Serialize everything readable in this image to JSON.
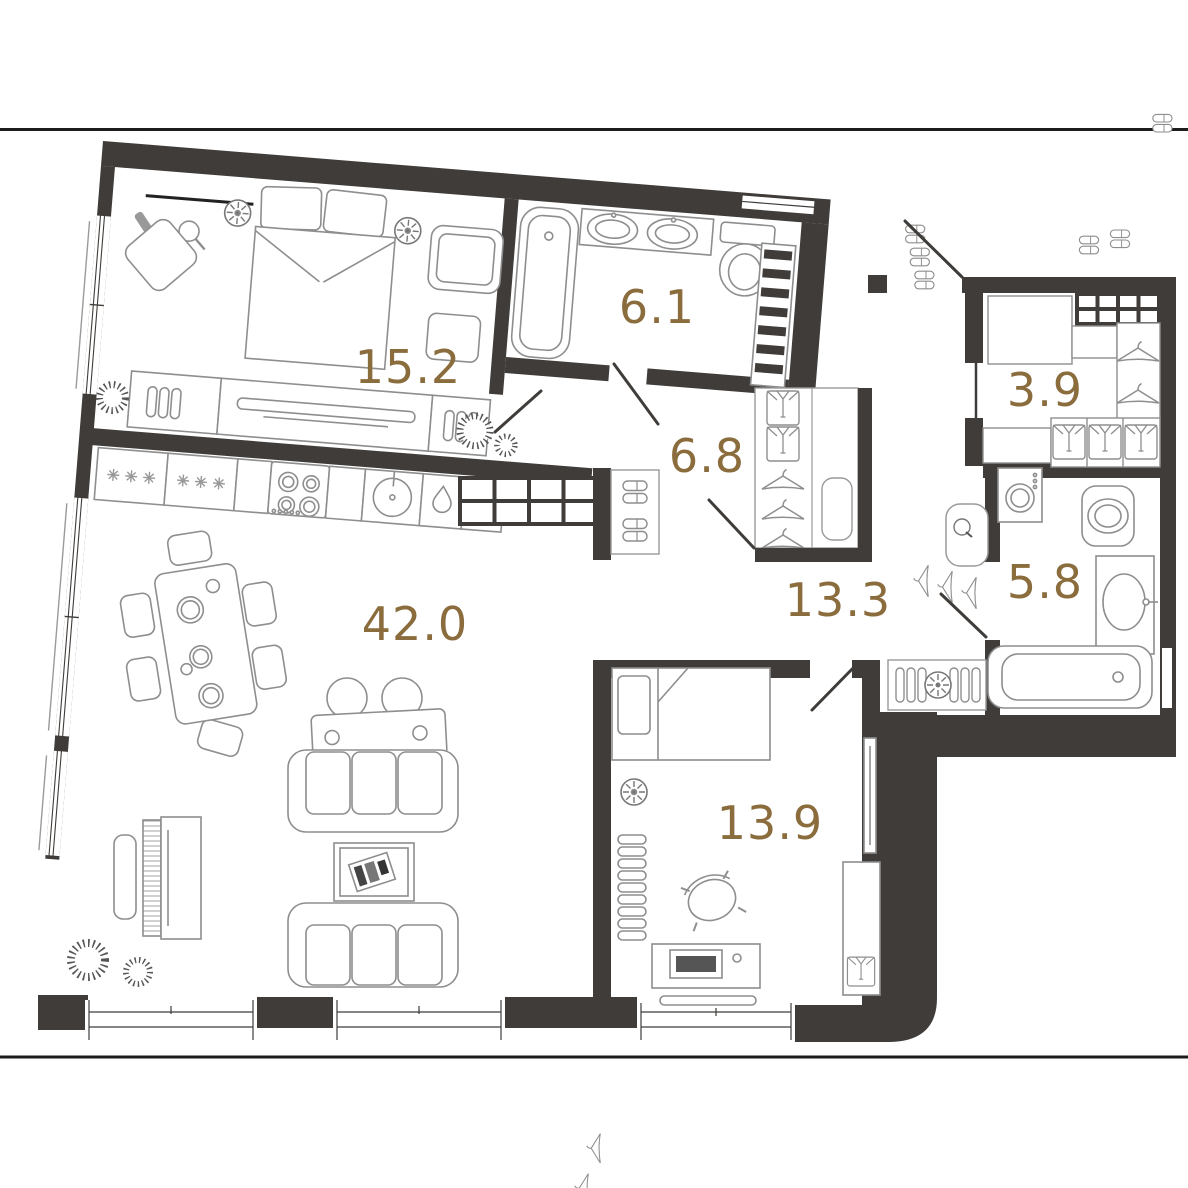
{
  "plan": {
    "type": "apartment-floor-plan",
    "units": "m2"
  },
  "colors": {
    "wall": "#3f3c39",
    "furniture_line": "#8e8e8e",
    "frame_line": "#1c1c1c",
    "label": "#8a6c3d",
    "background": "#ffffff"
  },
  "rooms": [
    {
      "id": "bedroom-main",
      "area": "15.2"
    },
    {
      "id": "bathroom-ensuite",
      "area": "6.1"
    },
    {
      "id": "hall-closet",
      "area": "6.8"
    },
    {
      "id": "wardrobe",
      "area": "3.9"
    },
    {
      "id": "bathroom-second",
      "area": "5.8"
    },
    {
      "id": "hallway",
      "area": "13.3"
    },
    {
      "id": "living-kitchen",
      "area": "42.0"
    },
    {
      "id": "bedroom-second",
      "area": "13.9"
    }
  ],
  "icons": {
    "bed": "double-bed-icon",
    "bathtub": "bathtub-icon",
    "sink": "sink-icon",
    "toilet": "toilet-icon",
    "towel_ladder": "towel-ladder-icon",
    "stove": "stove-icon",
    "fridge": "fridge-icon",
    "washer": "washing-machine-icon",
    "hanger": "hanger-icon",
    "slippers": "slippers-icon",
    "shirt": "shirt-icon",
    "sofa": "sofa-icon",
    "piano": "piano-icon",
    "dining_table": "dining-table-icon",
    "desk": "desk-icon",
    "plant": "plant-icon",
    "fan": "ceiling-fan-icon",
    "radiator": "radiator-icon",
    "boiler": "boiler-icon",
    "door": "door-swing-icon",
    "window": "window-icon"
  }
}
